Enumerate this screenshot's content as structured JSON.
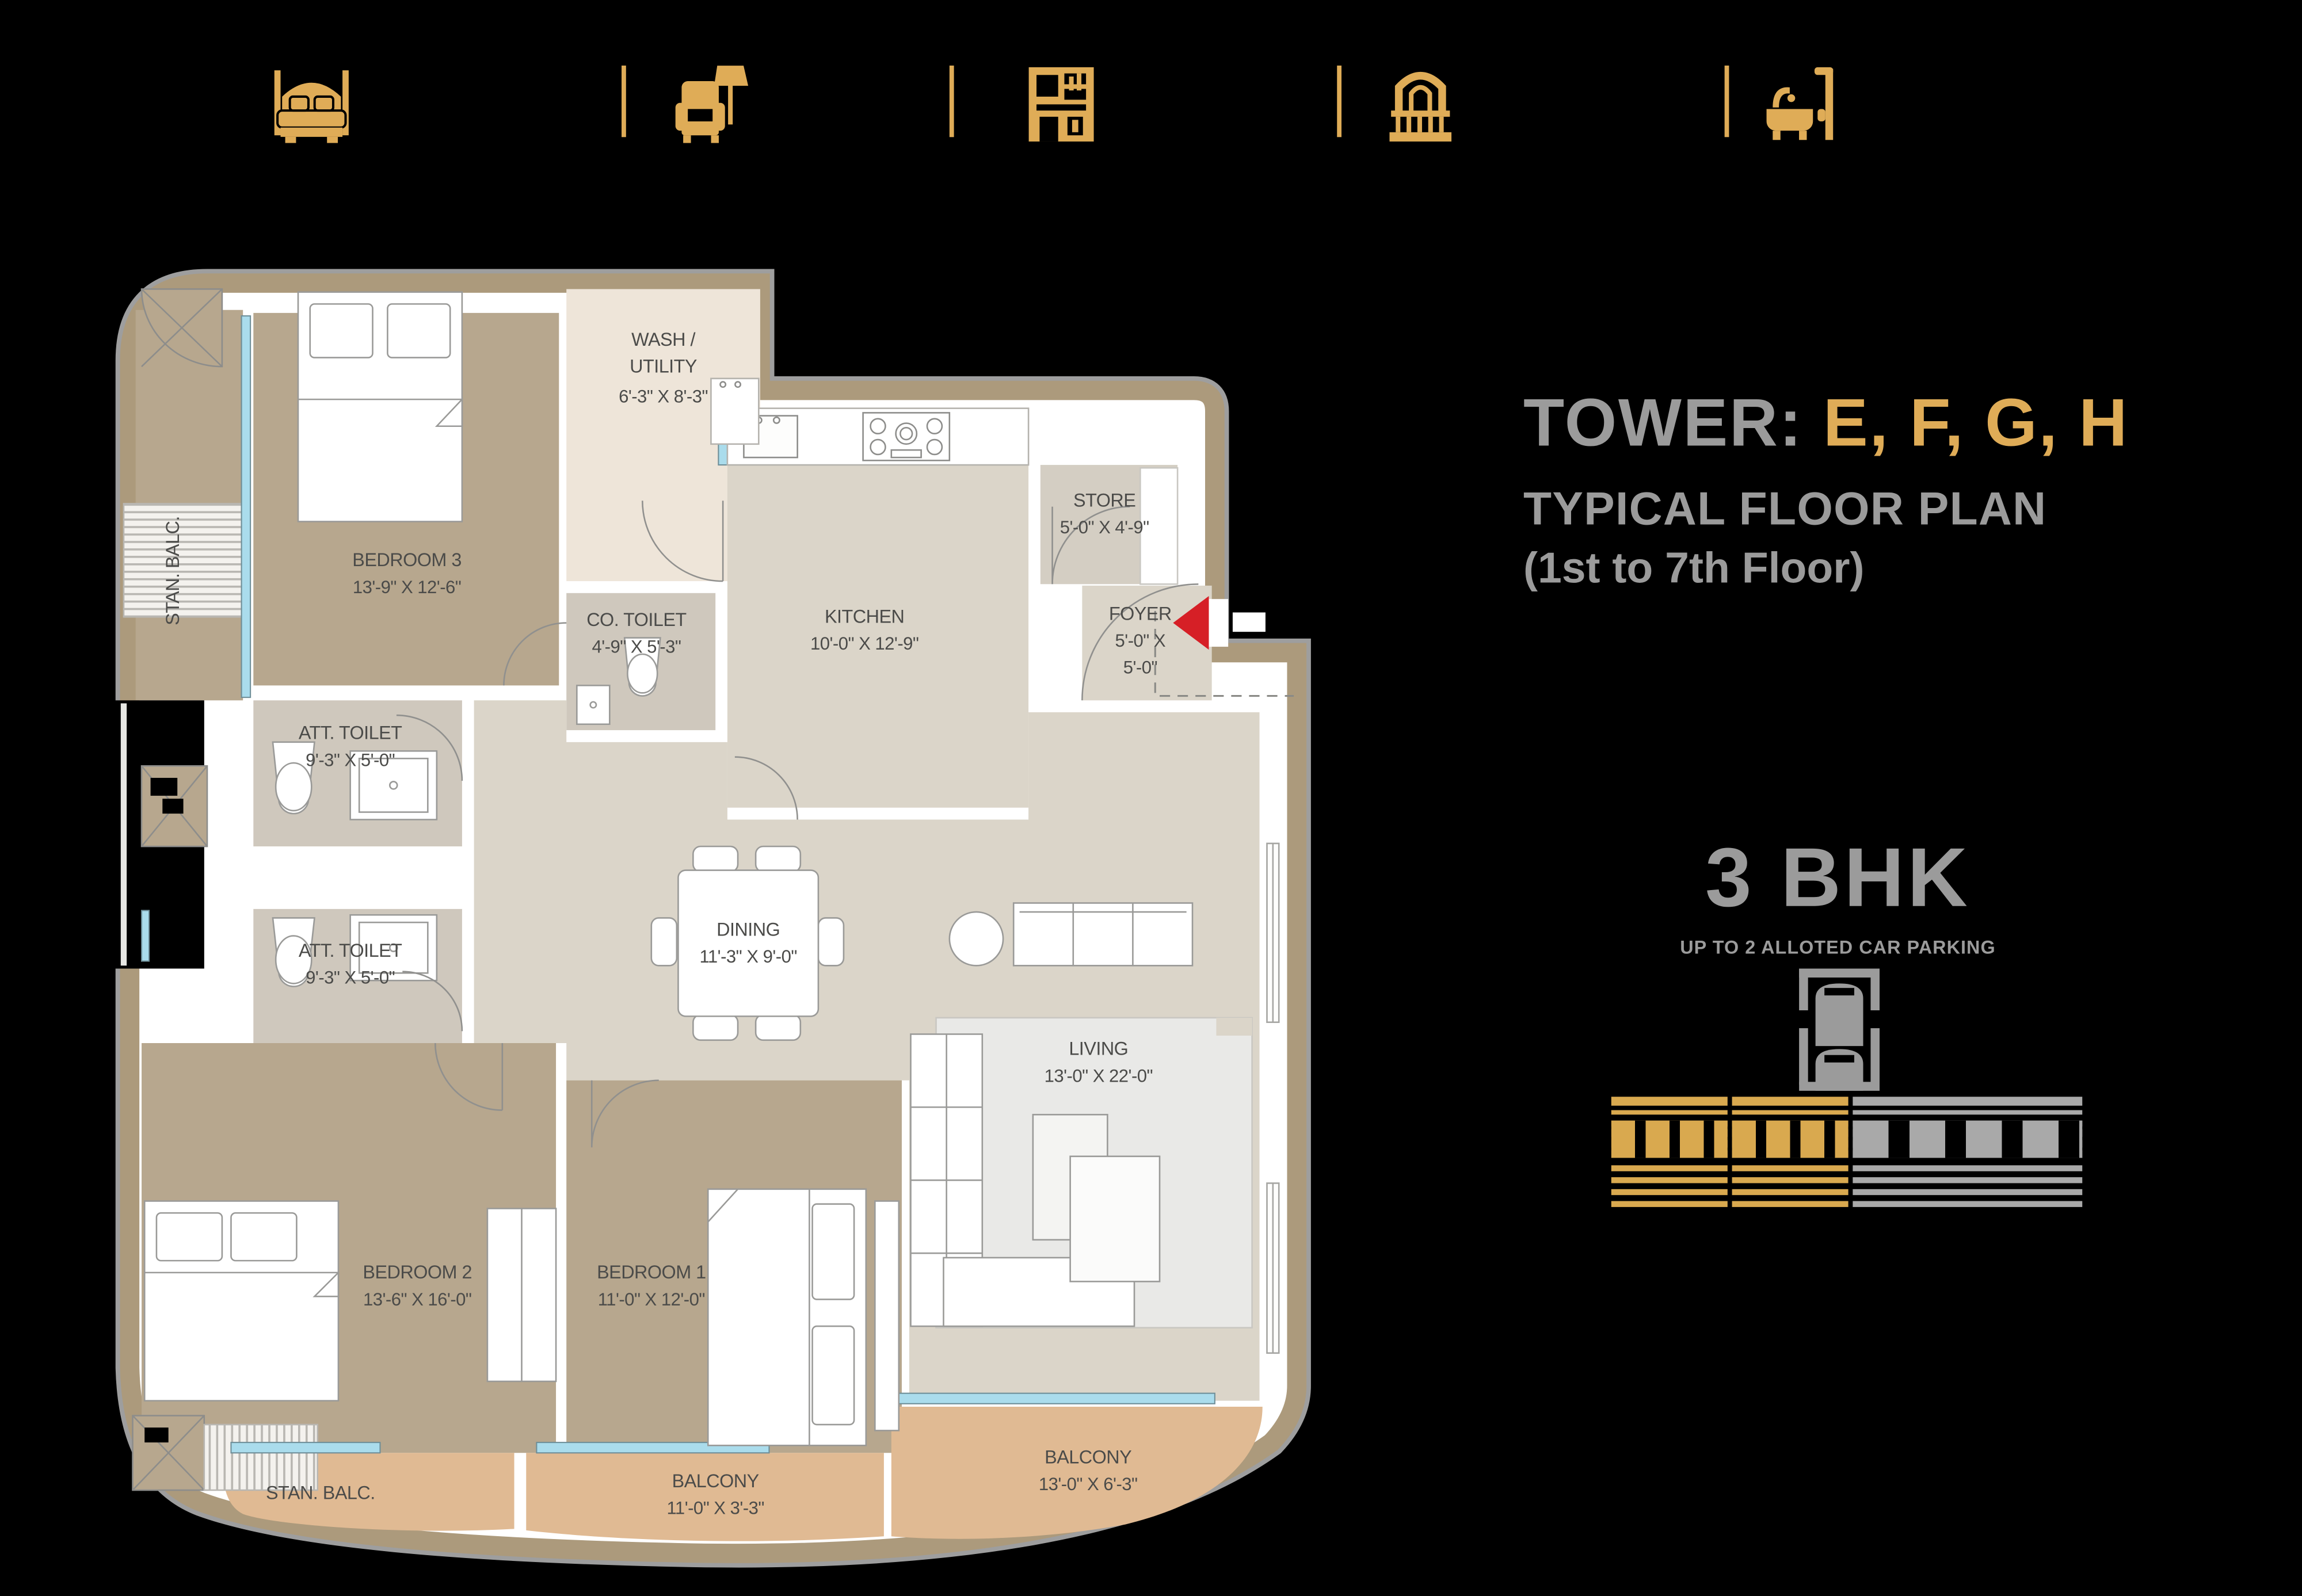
{
  "colors": {
    "background": "#000000",
    "gold": "#DFAC57",
    "gray_text": "#9B9B9B",
    "wall_band_tan": "#AC9A7C",
    "wall_shadow_gray": "#9E9E9E",
    "bedroom_floor": "#B7A78E",
    "common_floor": "#DBD5C9",
    "utility_floor": "#EEE5D9",
    "toilet_floor": "#CFC8BD",
    "store_floor": "#D4CEC3",
    "balcony_floor": "#E0BA93",
    "window_blue": "#AADCEC",
    "rug_gray": "#E9E9E7",
    "plan_text": "#4B4B49",
    "entry_arrow_red": "#D61F26"
  },
  "header": {
    "icons": [
      "bed",
      "armchair-lamp",
      "kitchen-cabinet",
      "balcony-arch",
      "bath"
    ]
  },
  "title": {
    "tower_label": "TOWER:",
    "tower_names": "E, F, G, H",
    "subtitle": "TYPICAL FLOOR PLAN",
    "floors": "(1st to 7th Floor)"
  },
  "unit": {
    "type": "3 BHK",
    "parking": "UP TO 2 ALLOTED CAR PARKING"
  },
  "plan": {
    "rooms": {
      "bedroom3": {
        "name": "BEDROOM 3",
        "dims": "13'-9\" X 12'-6\""
      },
      "wash": {
        "name1": "WASH /",
        "name2": "UTILITY",
        "dims": "6'-3\" X 8'-3\""
      },
      "co_toilet": {
        "name": "CO. TOILET",
        "dims": "4'-9\" X 5'-3\""
      },
      "kitchen": {
        "name": "KITCHEN",
        "dims": "10'-0\" X 12'-9\""
      },
      "store": {
        "name": "STORE",
        "dims": "5'-0\" X 4'-9\""
      },
      "foyer": {
        "name": "FOYER",
        "dims1": "5'-0\" X",
        "dims2": "5'-0\""
      },
      "att_toilet_1": {
        "name": "ATT. TOILET",
        "dims": "9'-3\" X 5'-0\""
      },
      "att_toilet_2": {
        "name": "ATT. TOILET",
        "dims": "9'-3\" X 5'-0\""
      },
      "dining": {
        "name": "DINING",
        "dims": "11'-3\" X 9'-0\""
      },
      "living": {
        "name": "LIVING",
        "dims": "13'-0\" X 22'-0\""
      },
      "bedroom2": {
        "name": "BEDROOM 2",
        "dims": "13'-6\" X 16'-0\""
      },
      "bedroom1": {
        "name": "BEDROOM 1",
        "dims": "11'-0\" X 12'-0\""
      }
    },
    "balconies": {
      "stan_balc_left": "STAN. BALC.",
      "stan_balc_bottom": "STAN. BALC.",
      "balcony1": {
        "name": "BALCONY",
        "dims": "11'-0\" X 3'-3\""
      },
      "balcony2": {
        "name": "BALCONY",
        "dims": "13'-0\" X 6'-3\""
      }
    }
  }
}
